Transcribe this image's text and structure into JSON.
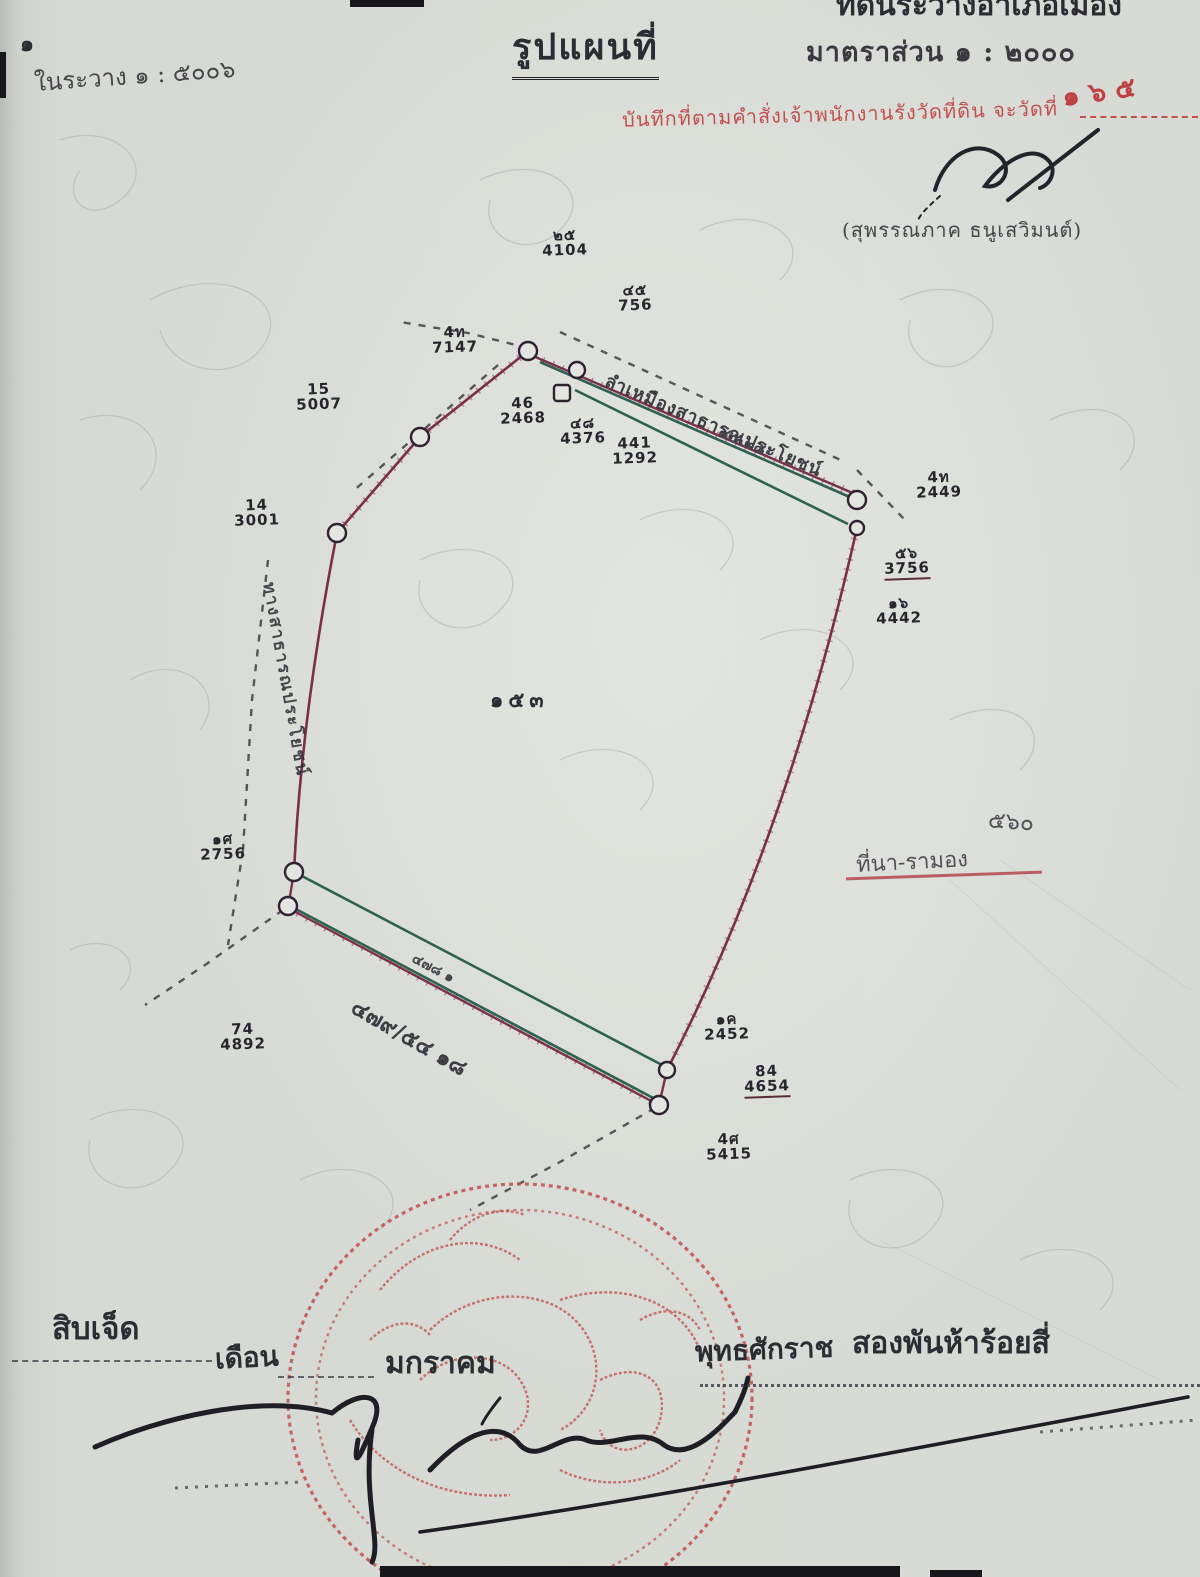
{
  "header": {
    "corner_mark": "๑",
    "left_note": "ในระวาง  ๑ : ๕๐๐๖",
    "title": "รูปแผนที่",
    "scale_label": "มาตราส่วน   ๑ : ๒๐๐๐",
    "top_cut_right": "ที่ดินระวางอำเภอเมืองอุดรธานี",
    "top_cut_left": "แผนที่"
  },
  "red_note": {
    "stamp_text": "บันทึกที่ตามคำสั่งเจ้าพนักงานรังวัดที่ดิน จะวัดที่",
    "handwriting": "๑ ๖ ๕"
  },
  "approver": {
    "name_line": "(สุพรรณภาค  ธนูเสวิมนต์)"
  },
  "map": {
    "parcel_number": "๑๕๓",
    "canal_name": "ลำเหมืองสาธารณประโยชน์",
    "canal_measure": "๔๕.๓๘",
    "road_name": "ทางสาธารณประโยชน์",
    "bottom_edge_small": "๔๗๘ ๑",
    "bottom_edge_note": "๔๗๙/๕๔ ๑๘",
    "side_note": "๕๖๐",
    "struck_note": "ที่นา-รามอง",
    "markers": [
      {
        "top": "๒๕",
        "bottom": "4104"
      },
      {
        "top": "๔๕",
        "bottom": "756"
      },
      {
        "top": "4ท",
        "bottom": "7147"
      },
      {
        "top": "15",
        "bottom": "5007"
      },
      {
        "top": "14",
        "bottom": "3001"
      },
      {
        "top": "46",
        "bottom": "2468"
      },
      {
        "top": "๔๘",
        "bottom": "4376"
      },
      {
        "top": "441",
        "bottom": "1292"
      },
      {
        "top": "4ท",
        "bottom": "2449"
      },
      {
        "top": "๕๖",
        "bottom": "3756"
      },
      {
        "top": "๑๖",
        "bottom": "4442"
      },
      {
        "top": "๑ศ",
        "bottom": "2756"
      },
      {
        "top": "74",
        "bottom": "4892"
      },
      {
        "top": "๑ค",
        "bottom": "2452"
      },
      {
        "top": "84",
        "bottom": "4654"
      },
      {
        "top": "4ศ",
        "bottom": "5415"
      }
    ]
  },
  "footer": {
    "day_word": "สิบเจ็ด",
    "month_label": "เดือน",
    "month_value": "มกราคม",
    "era_label": "พุทธศักราช",
    "year_words": "สองพันห้าร้อยสี่"
  },
  "colors": {
    "paper": "#d7dad4",
    "ink": "#2c2c33",
    "boundary_maroon": "#7a3048",
    "canal_green": "#2e6152",
    "stamp_red": "#c0504d",
    "note_red": "#bf4141"
  }
}
